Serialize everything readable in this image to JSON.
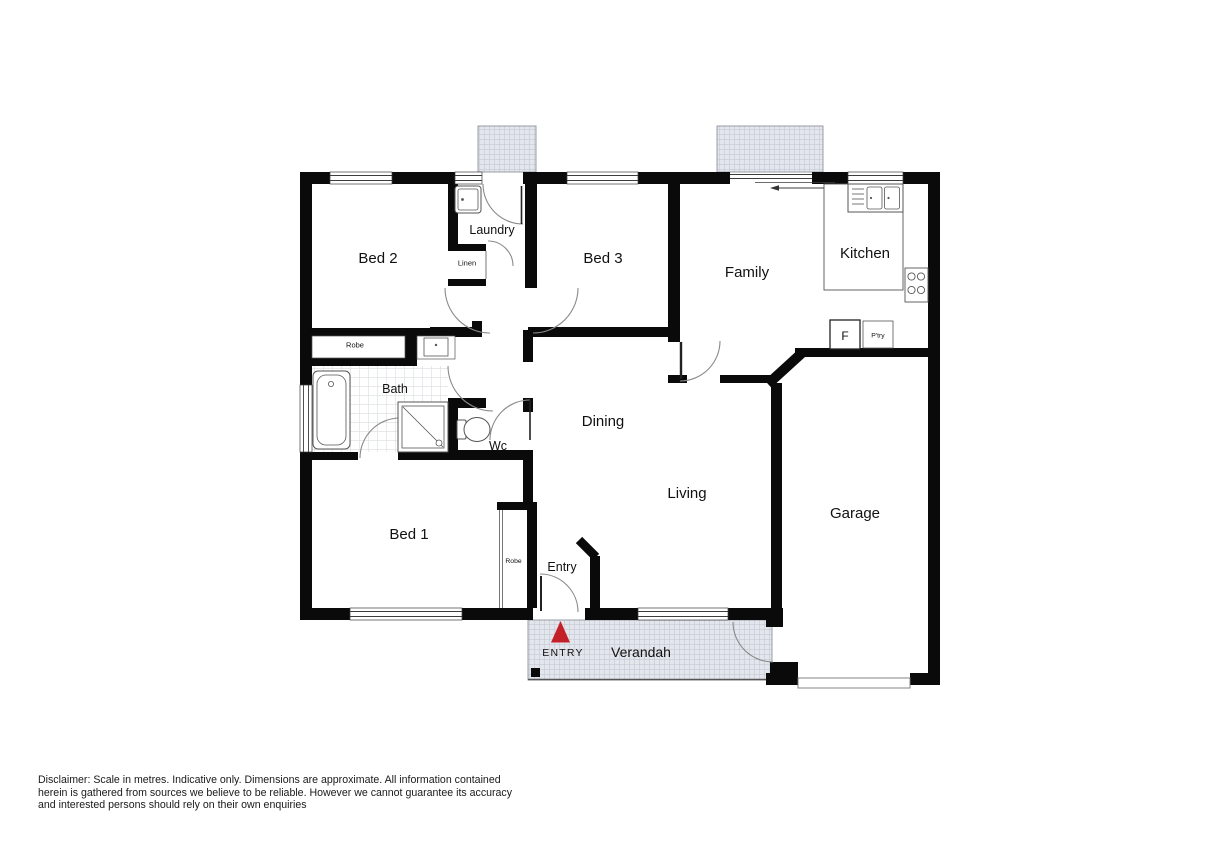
{
  "labels": {
    "bed1": "Bed 1",
    "bed2": "Bed 2",
    "bed3": "Bed 3",
    "laundry": "Laundry",
    "linen": "Linen",
    "robe_bed2": "Robe",
    "bath": "Bath",
    "wc": "Wc",
    "dining": "Dining",
    "living": "Living",
    "family": "Family",
    "kitchen": "Kitchen",
    "fridge": "F",
    "pantry": "P'try",
    "garage": "Garage",
    "robe_bed1": "Robe",
    "entry": "Entry",
    "entry_marker": "ENTRY",
    "verandah": "Verandah"
  },
  "colors": {
    "wall": "#0a0a0a",
    "entry_arrow": "#c32127",
    "hatch_fill": "#e3e6ec",
    "hatch_line": "#c9cdd7",
    "fixture_stroke": "#555555",
    "door_arc": "#8a8a8a"
  },
  "disclaimer": {
    "lines": [
      "Disclaimer: Scale in metres. Indicative only. Dimensions are approximate. All information contained",
      "herein is gathered from sources we believe to be reliable. However we cannot guarantee its accuracy",
      "and interested persons should rely on their own enquiries"
    ]
  }
}
